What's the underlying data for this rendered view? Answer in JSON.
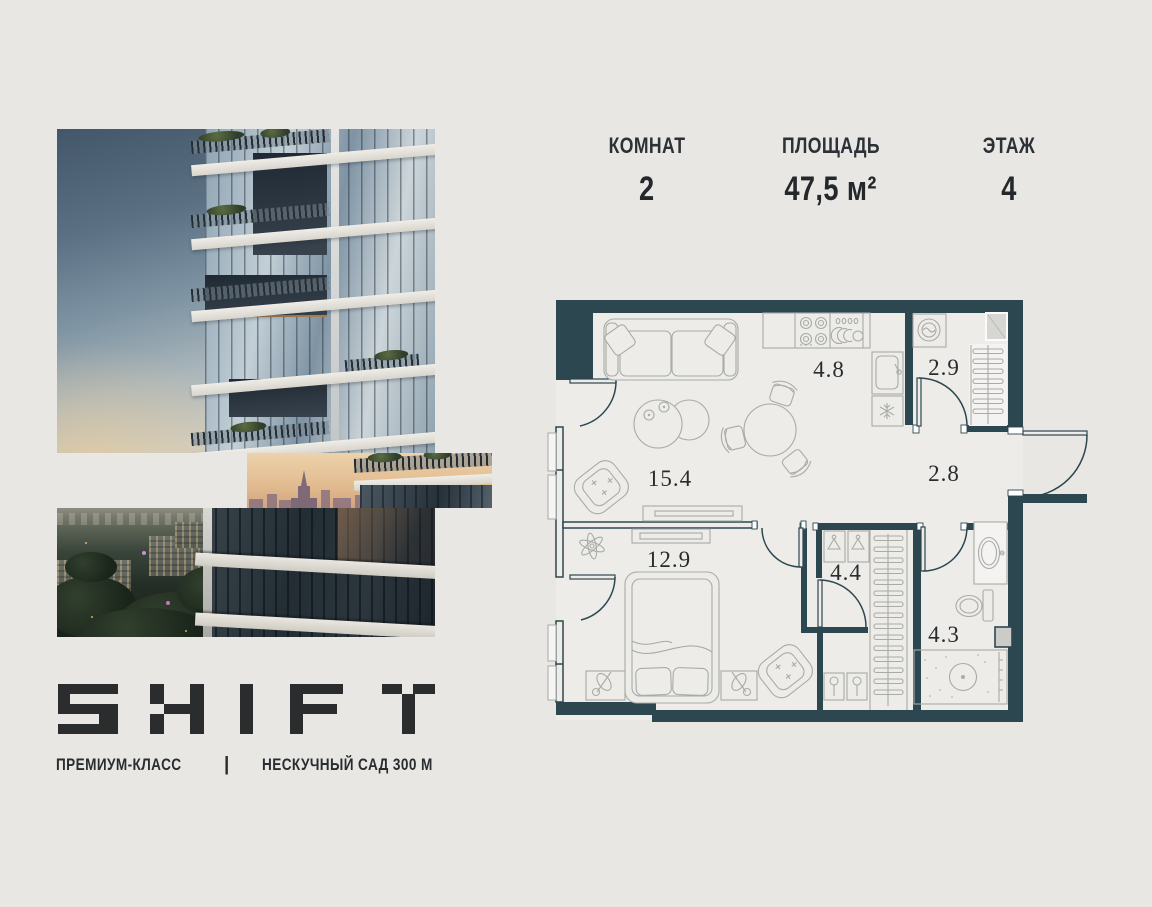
{
  "header": {
    "stats": [
      {
        "label": "КОМНАТ",
        "value": "2"
      },
      {
        "label": "ПЛОЩАДЬ",
        "value": "47,5 м²"
      },
      {
        "label": "ЭТАЖ",
        "value": "4"
      }
    ]
  },
  "brand": {
    "logo_text": "SHIFT",
    "premium_label": "ПРЕМИУМ-КЛАСС",
    "divider": "|",
    "location_label": "НЕСКУЧНЫЙ САД 300 М"
  },
  "floor_plan": {
    "areas": [
      "4.8",
      "2.9",
      "15.4",
      "2.8",
      "12.9",
      "4.4",
      "4.3"
    ]
  },
  "colors": {
    "background": "#e8e7e4",
    "wall": "#2d4750",
    "text_dark": "#26292c",
    "furniture_line": "#a8aba7"
  }
}
